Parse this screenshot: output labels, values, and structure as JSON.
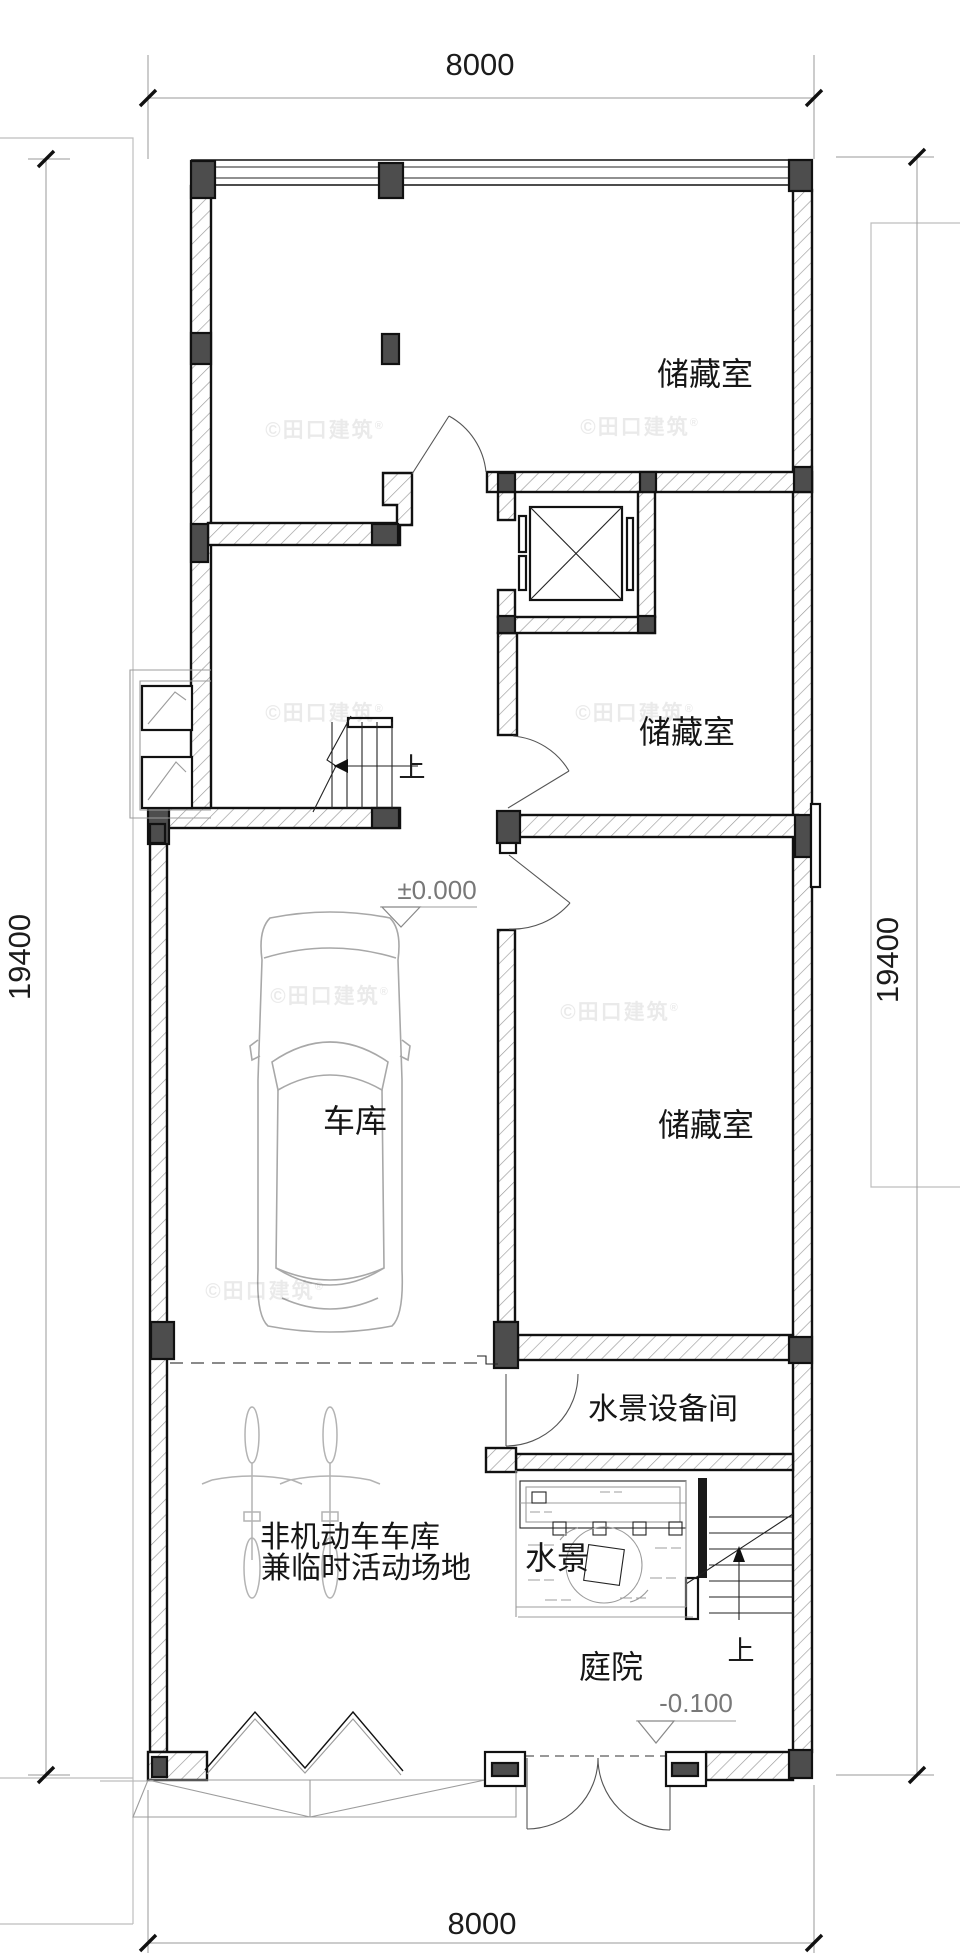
{
  "plan": {
    "dimensions": {
      "top": "8000",
      "bottom": "8000",
      "left": "19400",
      "right": "19400"
    },
    "rooms": {
      "storage1": "储藏室",
      "storage2": "储藏室",
      "storage3": "储藏室",
      "garage": "车库",
      "water_equipment": "水景设备间",
      "bike_garage_line1": "非机动车车库",
      "bike_garage_line2": "兼临时活动场地",
      "water_feature": "水景",
      "courtyard": "庭院"
    },
    "levels": {
      "ground": "±0.000",
      "courtyard": "-0.100"
    },
    "stair_up_label": "上",
    "watermark": {
      "text": "©田口建筑",
      "registered": "®"
    },
    "colors": {
      "line": "#111111",
      "column_fill": "#4d4d4d",
      "hatch": "#9a9a9a",
      "site_line": "#bdbdbd",
      "watermark": "#e8e8e8",
      "paper": "#ffffff"
    }
  }
}
